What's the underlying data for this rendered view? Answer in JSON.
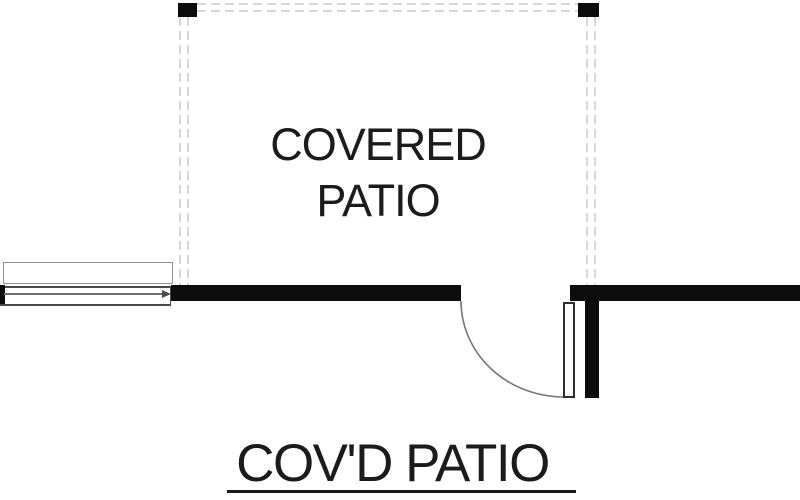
{
  "plan": {
    "room_label": "COVERED\nPATIO",
    "sheet_title": "COV'D PATIO"
  },
  "symbols": {
    "posts": [
      "column-post-left",
      "column-post-right"
    ],
    "door": "door-swing-arc",
    "window": "sliding-window-symbol"
  },
  "colors": {
    "wall": "#0c0c0c",
    "dash": "#d7d7d7",
    "text": "#1b1b1b",
    "line": "#6e6e6e"
  }
}
